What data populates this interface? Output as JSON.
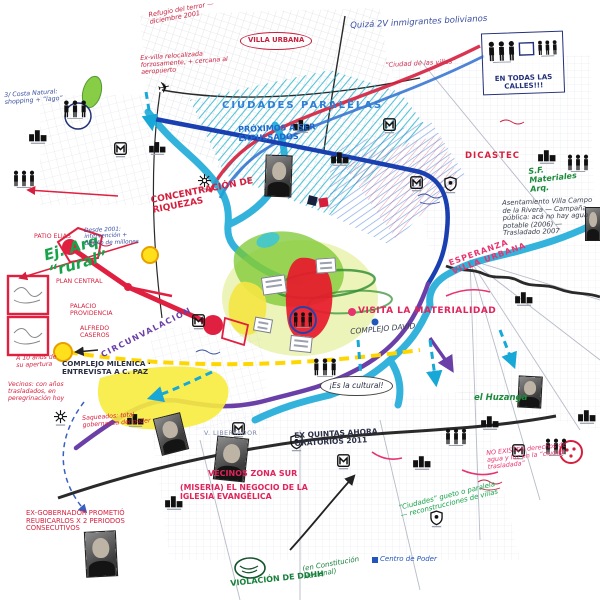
{
  "palette": {
    "river_cyan": "#18a8d8",
    "expressway_blue": "#1a3fb0",
    "ring_purple": "#6a3fa8",
    "route_red": "#d61f3d",
    "note_pink": "#e8336e",
    "note_green": "#17a34a",
    "highlight_yellow": "#f7ec3e",
    "zone_green": "#7cc832",
    "center_red": "#e8192c",
    "hatch_teal": "#25b4cd"
  },
  "icons": {
    "people-stamp-icon": "group of standing figures",
    "building-stamp-icon": "small building blocks",
    "metro-stamp-icon": "M logo in a square",
    "shield-stamp-icon": "shield crest",
    "gear-stamp-icon": "asterisk wheel",
    "airplane-icon": "airplane glyph",
    "portrait-photo": "black and white portrait photo"
  },
  "annotations": [
    {
      "id": "ciudades-paralelas",
      "text": "CIUDADES PARALELAS",
      "color": "#2f7fd6"
    },
    {
      "id": "quiza-inmigrantes",
      "text": "Quizá 2V inmigrantes bolivianos",
      "color": "#3a4fa0"
    },
    {
      "id": "en-todas-las-calles",
      "text": "EN TODAS LAS CALLES!!!",
      "color": "#22307a"
    },
    {
      "id": "refugio-terror",
      "text": "Refugio del terror — diciembre 2001",
      "color": "#c8203f"
    },
    {
      "id": "villa-urbana",
      "text": "VILLA URBANA",
      "color": "#c8203f"
    },
    {
      "id": "ex-villa",
      "text": "Ex-villa relocalizada forzosamente, + cercana al aeropuerto",
      "color": "#c8203f"
    },
    {
      "id": "proximos-expulsados",
      "text": "PRÓXIMOS A SER EXPULSADOS",
      "color": "#1e66cc"
    },
    {
      "id": "ciudad-villas",
      "text": "“Ciudad de las villas”",
      "color": "#cc3355"
    },
    {
      "id": "dicastec",
      "text": "DICASTEC",
      "color": "#d61f3d"
    },
    {
      "id": "sf-materiales",
      "text": "S.F. Materiales Arq.",
      "color": "#1b8a3a"
    },
    {
      "id": "asentamiento-rivera",
      "text": "Asentamiento Villa Campo de la Rivera — Campaña pública: acá no hay agua potable (2006) — Trasladado 2007",
      "color": "#39404f"
    },
    {
      "id": "esperanza-villa",
      "text": "ESPERANZA VILLA URBANA",
      "color": "#e8336e"
    },
    {
      "id": "visita-materialidad",
      "text": "VISITA LA MATERIALIDAD",
      "color": "#e0245c"
    },
    {
      "id": "complejo-david",
      "text": "COMPLEJO DAVID",
      "color": "#39404f"
    },
    {
      "id": "concentracion-riquezas",
      "text": "CONCENTRACIÓN DE RIQUEZAS",
      "color": "#d61f3d"
    },
    {
      "id": "ej-arq",
      "text": "Ej. Arq “rural”",
      "color": "#17a34a"
    },
    {
      "id": "patio-elias",
      "text": "PATIO ELIAS",
      "color": "#d61f3d"
    },
    {
      "id": "plan-central",
      "text": "PLAN CENTRAL",
      "color": "#d61f3d"
    },
    {
      "id": "palacio-providencia",
      "text": "PALACIO PROVIDENCIA",
      "color": "#d61f3d"
    },
    {
      "id": "alfredo-caseros",
      "text": "ALFREDO CASEROS",
      "color": "#d61f3d"
    },
    {
      "id": "complejo-milenica",
      "text": "COMPLEJO MILENICA · ENTREVISTA A C. PAZ",
      "color": "#2b2f44"
    },
    {
      "id": "diez-anos",
      "text": "A 10 años de su apertura",
      "color": "#d61f3d"
    },
    {
      "id": "circunvalacion",
      "text": "CIRCUNVALACIÓN",
      "color": "#6a3fa8"
    },
    {
      "id": "saqueados",
      "text": "Saqueados: total gobernanza del poder",
      "color": "#d61f3d"
    },
    {
      "id": "ex-gobernador",
      "text": "EX-GOBERNADOR PROMETIÓ REUBICARLOS X 2 PERIODOS CONSECUTIVOS",
      "color": "#d61f3d"
    },
    {
      "id": "vecinos-zona-sur",
      "text": "VECINOS ZONA SUR",
      "color": "#e0245c"
    },
    {
      "id": "miseria-iglesia",
      "text": "(MISERIA) EL NEGOCIO DE LA IGLESIA EVANGÉLICA",
      "color": "#e0245c"
    },
    {
      "id": "ex-quintas",
      "text": "EX QUINTAS AHORA ORATORIOS 2011",
      "color": "#2b2f44"
    },
    {
      "id": "es-la-cultural",
      "text": "¡Es la cultural!",
      "color": "#2b2f44"
    },
    {
      "id": "violacion-ddhh",
      "text": "VIOLACIÓN DE DDHH",
      "color": "#17803a"
    },
    {
      "id": "constitucion-nacional",
      "text": "(en Constitución Nacional)",
      "color": "#17803a"
    },
    {
      "id": "centro-de-poder",
      "text": "Centro de Poder",
      "color": "#2255bb"
    },
    {
      "id": "el-huzanga",
      "text": "el Huzanga",
      "color": "#1b8a3a"
    },
    {
      "id": "ciudades-gueto",
      "text": "“Ciudades” gueto o paralela — reconstrucciones de villas",
      "color": "#17a34a"
    },
    {
      "id": "vecinos-trasladados",
      "text": "Vecinos: con años trasladados, en peregrinación hoy",
      "color": "#d61f3d"
    },
    {
      "id": "costa-natural",
      "text": "3/ Costa Natural: shopping + “lago”",
      "color": "#3a4fa0"
    },
    {
      "id": "desde-2001",
      "text": "Desde 2001: intervención + diseño de millones",
      "color": "#3a4fa0"
    },
    {
      "id": "sin-derechos",
      "text": "NO EXISTEN derechos de agua y luz en la “ciudad trasladada”",
      "color": "#e8336e"
    },
    {
      "id": "v-libertador",
      "text": "V. LIBERTADOR",
      "color": "#7b86a8"
    }
  ]
}
